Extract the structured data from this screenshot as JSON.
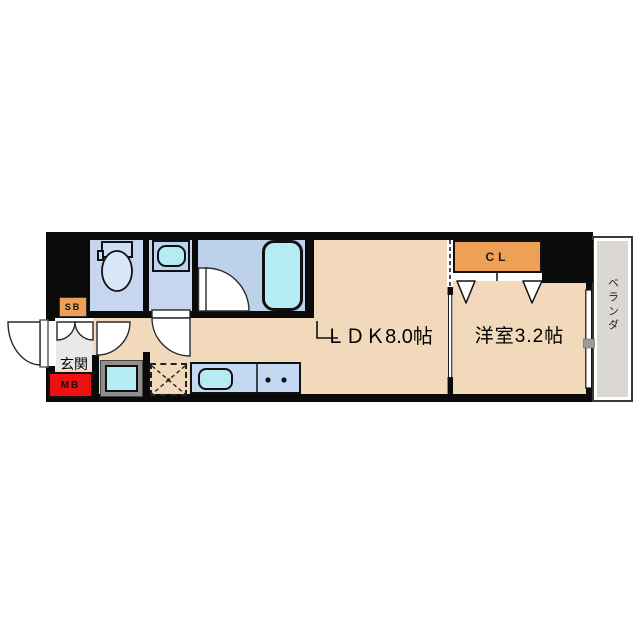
{
  "title": "1LDK apartment floor plan",
  "rooms": {
    "ldk": {
      "label": "ＬＤＫ8.0帖"
    },
    "bedroom": {
      "label": "洋室3.2帖"
    },
    "entrance": {
      "label": "玄関"
    },
    "closet": {
      "label": "CL"
    },
    "shoe_box": {
      "label": "SB"
    },
    "meter_box": {
      "label": "MB"
    },
    "balcony": {
      "label": "ベランダ"
    }
  },
  "fixtures": [
    "toilet",
    "washbasin",
    "bathtub",
    "washing-machine-space",
    "refrigerator-space",
    "kitchen-sink",
    "stove-burners",
    "closet-folding-doors",
    "sliding-door",
    "balcony-window"
  ],
  "colors": {
    "wall": "#0a0a0a",
    "floor": "#f3d9bc",
    "wet_room": "#c6d6ee",
    "bathroom": "#bdd1ea",
    "fixture_cyan": "#b5ecf4",
    "counter_blue": "#c3d9f2",
    "closet_orange": "#efa057",
    "meter_box_red": "#ee1111",
    "balcony_gray": "#dbd7d2",
    "entrance_gray": "#e9e9e9"
  }
}
